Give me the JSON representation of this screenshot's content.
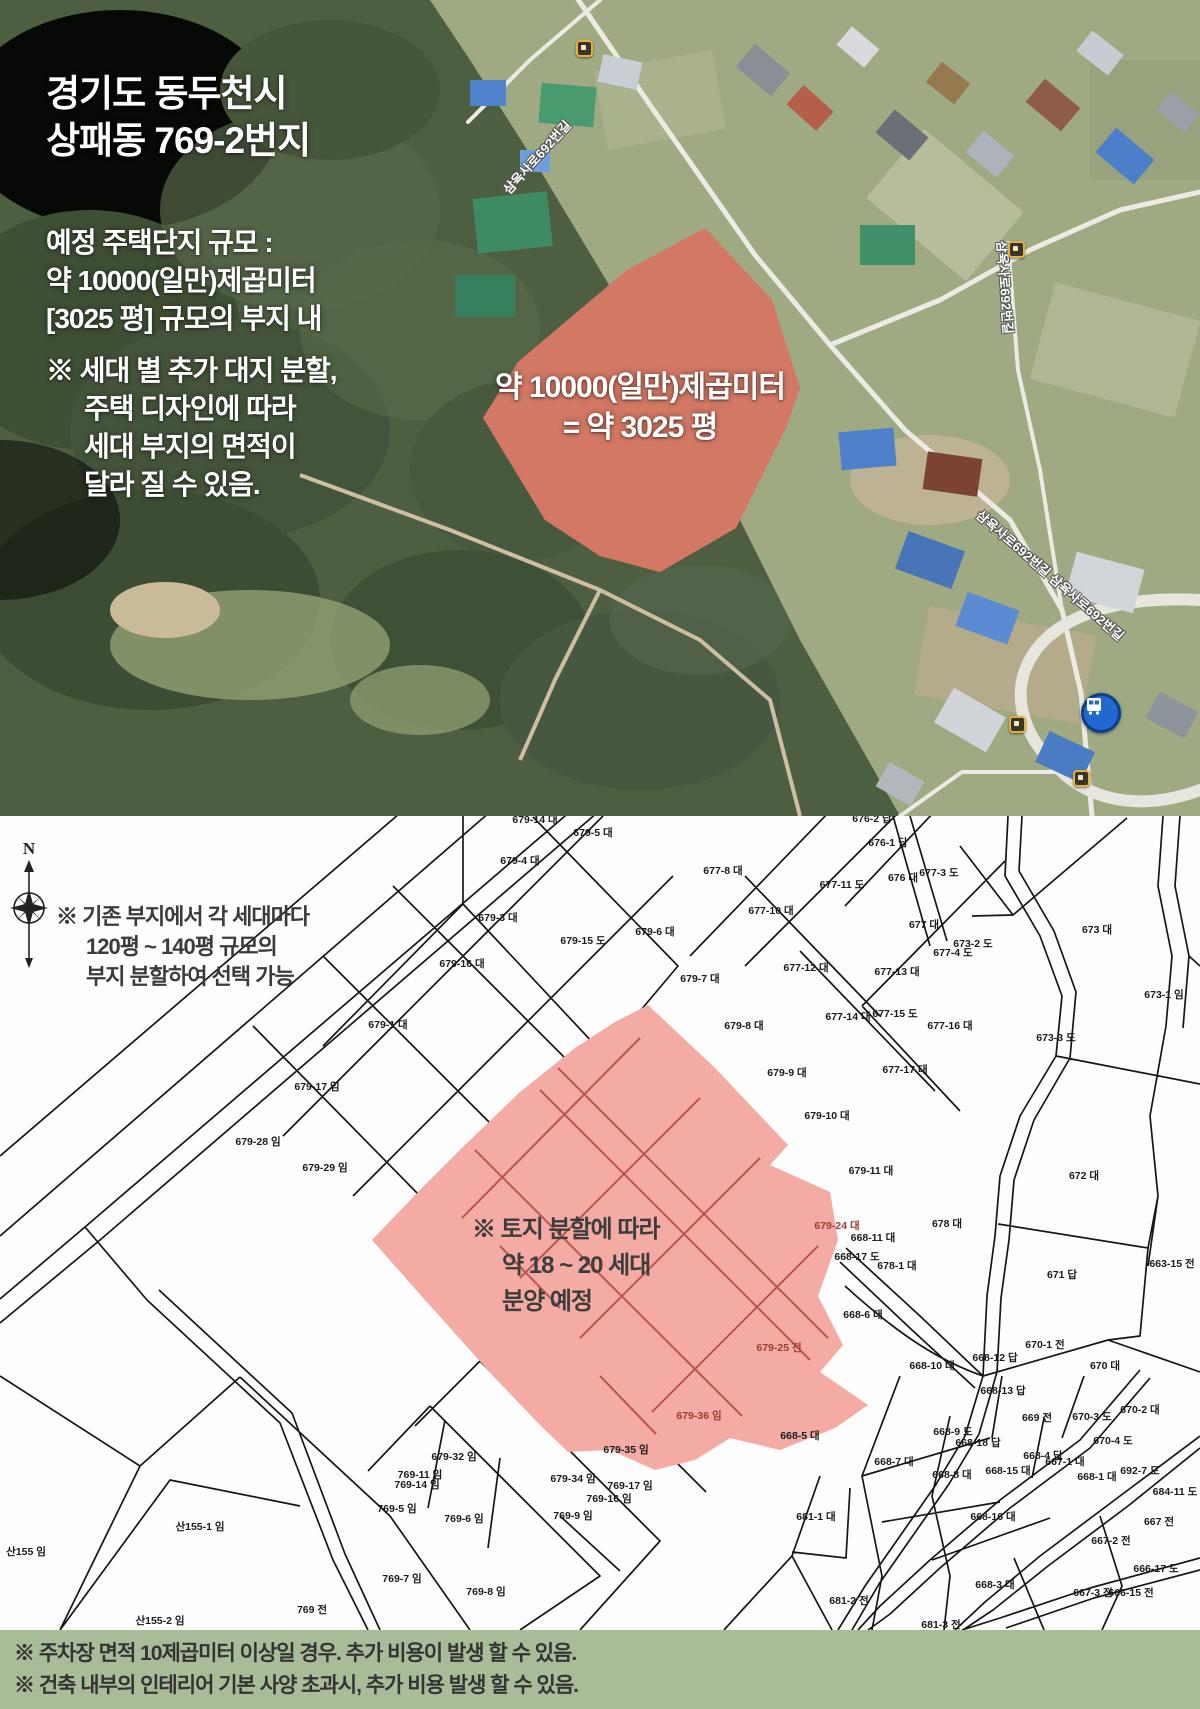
{
  "satellite": {
    "title": [
      "경기도 동두천시",
      "상패동 769-2번지"
    ],
    "body": [
      "예정 주택단지 규모 :",
      "약 10000(일만)제곱미터",
      "[3025 평] 규모의 부지 내"
    ],
    "note": [
      "※ 세대 별 추가 대지 분할,",
      "주택 디자인에 따라",
      "세대 부지의 면적이",
      "달라 질 수 있음."
    ],
    "area_label": [
      "약 10000(일만)제곱미터",
      "= 약 3025 평"
    ],
    "road_labels": [
      {
        "text": "삼육사로692번길",
        "x": 498,
        "y": 185,
        "rot": -48
      },
      {
        "text": "삼육사로692번길",
        "x": 1012,
        "y": 240,
        "rot": 86
      },
      {
        "text": "삼육사로692번길 삼육사로692번길",
        "x": 985,
        "y": 505,
        "rot": 41
      }
    ],
    "markers": [
      {
        "x": 576,
        "y": 40
      },
      {
        "x": 1008,
        "y": 241
      },
      {
        "x": 1009,
        "y": 716
      },
      {
        "x": 1073,
        "y": 770
      }
    ],
    "bus_icon": {
      "x": 1081,
      "y": 693
    }
  },
  "cadastral": {
    "compass": "N",
    "note": [
      "※ 기존 부지에서 각 세대마다",
      "120평 ~ 140평 규모의",
      "부지 분할하여 선택 가능"
    ],
    "area_note": [
      "※ 토지 분할에 따라",
      "약 18 ~ 20 세대",
      "분양 예정"
    ],
    "lots": [
      {
        "x": 535,
        "y": 7,
        "t": "679-14 대"
      },
      {
        "x": 593,
        "y": 20,
        "t": "679-5 대"
      },
      {
        "x": 872,
        "y": 6,
        "t": "676-2 답"
      },
      {
        "x": 888,
        "y": 30,
        "t": "676-1 답"
      },
      {
        "x": 520,
        "y": 48,
        "t": "679-4 대"
      },
      {
        "x": 723,
        "y": 58,
        "t": "677-8 대"
      },
      {
        "x": 903,
        "y": 65,
        "t": "676 대"
      },
      {
        "x": 939,
        "y": 60,
        "t": "677-3 도"
      },
      {
        "x": 842,
        "y": 72,
        "t": "677-11 도"
      },
      {
        "x": 771,
        "y": 98,
        "t": "677-10 대"
      },
      {
        "x": 498,
        "y": 105,
        "t": "679-3 대"
      },
      {
        "x": 924,
        "y": 112,
        "t": "677 대"
      },
      {
        "x": 655,
        "y": 119,
        "t": "679-6 대"
      },
      {
        "x": 1097,
        "y": 117,
        "t": "673 대"
      },
      {
        "x": 583,
        "y": 128,
        "t": "679-15 도"
      },
      {
        "x": 973,
        "y": 131,
        "t": "673-2 도"
      },
      {
        "x": 953,
        "y": 140,
        "t": "677-4 도"
      },
      {
        "x": 462,
        "y": 151,
        "t": "679-16 대"
      },
      {
        "x": 806,
        "y": 155,
        "t": "677-12 대"
      },
      {
        "x": 897,
        "y": 159,
        "t": "677-13 대"
      },
      {
        "x": 700,
        "y": 166,
        "t": "679-7 대"
      },
      {
        "x": 1164,
        "y": 182,
        "t": "673-1 임"
      },
      {
        "x": 388,
        "y": 212,
        "t": "679-1 대"
      },
      {
        "x": 848,
        "y": 204,
        "t": "677-14 대"
      },
      {
        "x": 895,
        "y": 201,
        "t": "677-15 도"
      },
      {
        "x": 950,
        "y": 213,
        "t": "677-16 대"
      },
      {
        "x": 744,
        "y": 213,
        "t": "679-8 대"
      },
      {
        "x": 1056,
        "y": 225,
        "t": "673-3 도"
      },
      {
        "x": 905,
        "y": 257,
        "t": "677-17 대"
      },
      {
        "x": 787,
        "y": 260,
        "t": "679-9 대"
      },
      {
        "x": 317,
        "y": 274,
        "t": "679-17 임"
      },
      {
        "x": 827,
        "y": 303,
        "t": "679-10 대"
      },
      {
        "x": 258,
        "y": 329,
        "t": "679-28 임"
      },
      {
        "x": 325,
        "y": 355,
        "t": "679-29 임"
      },
      {
        "x": 871,
        "y": 358,
        "t": "679-11 대"
      },
      {
        "x": 1084,
        "y": 363,
        "t": "672 대"
      },
      {
        "x": 947,
        "y": 411,
        "t": "678 대"
      },
      {
        "x": 837,
        "y": 413,
        "t": "679-24 대",
        "red": true
      },
      {
        "x": 873,
        "y": 425,
        "t": "668-11 대"
      },
      {
        "x": 857,
        "y": 444,
        "t": "668-17 도"
      },
      {
        "x": 897,
        "y": 453,
        "t": "678-1 대"
      },
      {
        "x": 1062,
        "y": 462,
        "t": "671 답"
      },
      {
        "x": 1172,
        "y": 451,
        "t": "663-15 전"
      },
      {
        "x": 863,
        "y": 502,
        "t": "668-6 대"
      },
      {
        "x": 779,
        "y": 535,
        "t": "679-25 전",
        "red": true
      },
      {
        "x": 1045,
        "y": 532,
        "t": "670-1 전"
      },
      {
        "x": 932,
        "y": 553,
        "t": "668-10 대"
      },
      {
        "x": 995,
        "y": 545,
        "t": "668-12 답"
      },
      {
        "x": 1105,
        "y": 553,
        "t": "670 대"
      },
      {
        "x": 1003,
        "y": 578,
        "t": "668-13 답"
      },
      {
        "x": 699,
        "y": 603,
        "t": "679-36 임",
        "red": true
      },
      {
        "x": 1037,
        "y": 605,
        "t": "669 전"
      },
      {
        "x": 1092,
        "y": 604,
        "t": "670-3 도"
      },
      {
        "x": 1140,
        "y": 597,
        "t": "670-2 대"
      },
      {
        "x": 800,
        "y": 623,
        "t": "668-5 대"
      },
      {
        "x": 953,
        "y": 619,
        "t": "668-9 도"
      },
      {
        "x": 978,
        "y": 630,
        "t": "668-18 답"
      },
      {
        "x": 1113,
        "y": 628,
        "t": "670-4 도"
      },
      {
        "x": 626,
        "y": 637,
        "t": "679-35 임"
      },
      {
        "x": 454,
        "y": 644,
        "t": "679-32 임"
      },
      {
        "x": 894,
        "y": 649,
        "t": "668-7 대"
      },
      {
        "x": 1043,
        "y": 643,
        "t": "668-4 답"
      },
      {
        "x": 1065,
        "y": 649,
        "t": "667-1 대"
      },
      {
        "x": 1140,
        "y": 658,
        "t": "692-7 도"
      },
      {
        "x": 420,
        "y": 662,
        "t": "769-11 임"
      },
      {
        "x": 417,
        "y": 672,
        "t": "769-14 임"
      },
      {
        "x": 573,
        "y": 666,
        "t": "679-34 임"
      },
      {
        "x": 630,
        "y": 673,
        "t": "769-17 임"
      },
      {
        "x": 952,
        "y": 662,
        "t": "668-8 대"
      },
      {
        "x": 1008,
        "y": 658,
        "t": "668-15 대"
      },
      {
        "x": 1097,
        "y": 664,
        "t": "668-1 대"
      },
      {
        "x": 1175,
        "y": 679,
        "t": "684-11 도"
      },
      {
        "x": 609,
        "y": 686,
        "t": "769-16 임"
      },
      {
        "x": 397,
        "y": 696,
        "t": "769-5 임"
      },
      {
        "x": 573,
        "y": 703,
        "t": "769-9 임"
      },
      {
        "x": 464,
        "y": 706,
        "t": "769-6 임"
      },
      {
        "x": 816,
        "y": 704,
        "t": "681-1 대"
      },
      {
        "x": 993,
        "y": 704,
        "t": "668-16 대"
      },
      {
        "x": 1159,
        "y": 709,
        "t": "667 전"
      },
      {
        "x": 200,
        "y": 714,
        "t": "산155-1 임"
      },
      {
        "x": 1111,
        "y": 728,
        "t": "667-2 전"
      },
      {
        "x": 26,
        "y": 739,
        "t": "산155 임"
      },
      {
        "x": 1156,
        "y": 756,
        "t": "666-17 도"
      },
      {
        "x": 402,
        "y": 766,
        "t": "769-7 임"
      },
      {
        "x": 486,
        "y": 779,
        "t": "769-8 임"
      },
      {
        "x": 995,
        "y": 772,
        "t": "668-3 대"
      },
      {
        "x": 1093,
        "y": 780,
        "t": "667-3 전"
      },
      {
        "x": 1131,
        "y": 780,
        "t": "666-15 전"
      },
      {
        "x": 312,
        "y": 797,
        "t": "769 전"
      },
      {
        "x": 849,
        "y": 788,
        "t": "681-2 전"
      },
      {
        "x": 941,
        "y": 812,
        "t": "681-3 전"
      },
      {
        "x": 160,
        "y": 808,
        "t": "산155-2 임"
      }
    ]
  },
  "footer": {
    "lines": [
      "※ 주차장 면적 10제곱미터 이상일 경우. 추가 비용이 발생 할 수 있음.",
      "※ 건축 내부의 인테리어 기본 사양 초과시, 추가 비용 발생 할 수 있음."
    ]
  },
  "colors": {
    "highlight": "#e0554a",
    "highlight_dark": "#b4524a",
    "pink_fill": "#f3aba3",
    "footer_bg": "#a9bc98"
  }
}
